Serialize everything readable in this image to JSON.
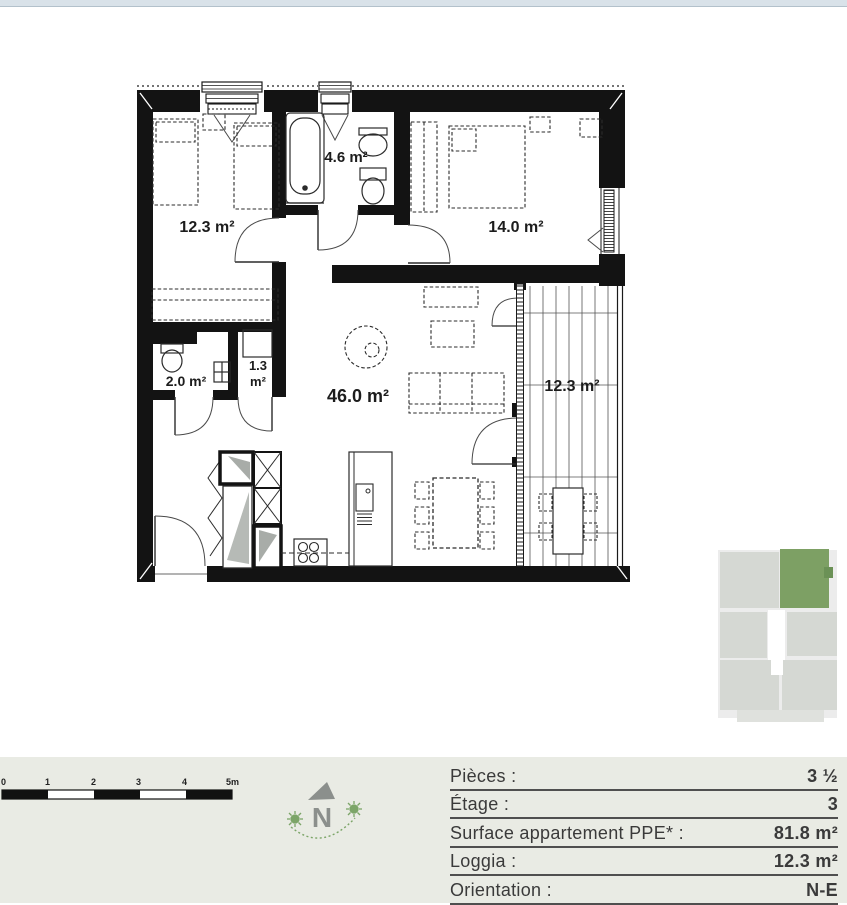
{
  "colors": {
    "wall": "#131313",
    "band_bg": "#e9ebe4",
    "top_strip": "#d9e2e9",
    "accent_green": "#7ca568",
    "compass_gray": "#8b8f8c",
    "minimap_unit": "#d5d8d3",
    "minimap_highlight": "#7da064",
    "minimap_highlight_dark": "#6b9156",
    "table_text": "#3a3a3a"
  },
  "plan": {
    "rooms": {
      "bedroom1": {
        "label": "12.3 m²"
      },
      "bathroom": {
        "label": "4.6 m²"
      },
      "bedroom2": {
        "label": "14.0 m²"
      },
      "wc": {
        "label": "2.0 m²"
      },
      "reduit": {
        "label_line1": "1.3",
        "label_line2": "m²"
      },
      "living": {
        "label": "46.0 m²"
      },
      "loggia": {
        "label": "12.3 m²"
      }
    }
  },
  "scalebar": {
    "labels": [
      "0",
      "1",
      "2",
      "3",
      "4",
      "5m"
    ]
  },
  "compass": {
    "north_label": "N"
  },
  "details_table": {
    "rows": [
      {
        "label": "Pièces :",
        "value": "3 ½"
      },
      {
        "label": "Étage :",
        "value": "3"
      },
      {
        "label": "Surface appartement PPE* :",
        "value": "81.8 m²"
      },
      {
        "label": "Loggia :",
        "value": "12.3 m²"
      },
      {
        "label": "Orientation :",
        "value": "N-E"
      }
    ]
  }
}
